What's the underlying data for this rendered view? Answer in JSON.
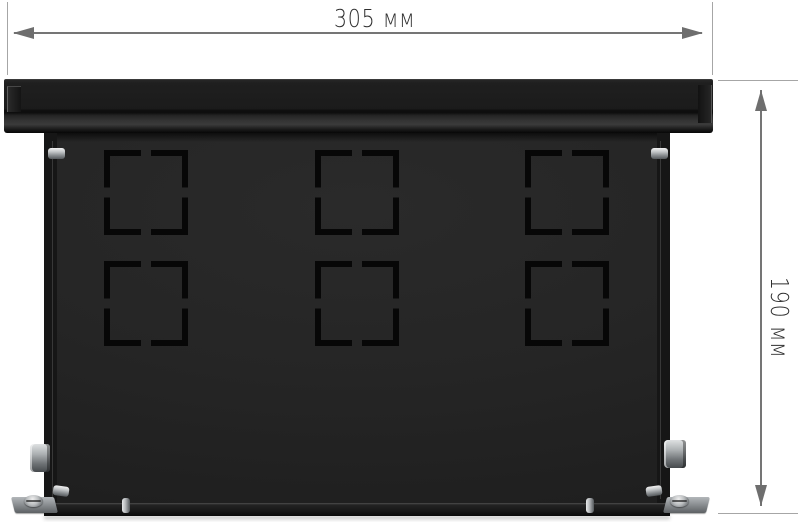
{
  "image": {
    "kind": "product-dimension-diagram",
    "background_color": "#ffffff"
  },
  "dimensions": {
    "width": {
      "label": "305 мм",
      "value": 305,
      "unit": "мм"
    },
    "height": {
      "label": "190 мм",
      "value": 190,
      "unit": "мм"
    }
  },
  "enclosure": {
    "body_color": "#1d1d1d",
    "knockouts": {
      "rows": 2,
      "columns": 3,
      "count": 6
    },
    "hardware": {
      "side_screws": 2,
      "bottom_pins": 4,
      "cable_glands": 2,
      "mounting_feet": 2,
      "metal_color": "#b0b4b7"
    }
  },
  "annotation_style": {
    "dimension_line_color": "#757575",
    "extension_line_color": "#a6a6a6",
    "arrow_color": "#6e6e6e",
    "label_color": "#2f2f2f"
  }
}
